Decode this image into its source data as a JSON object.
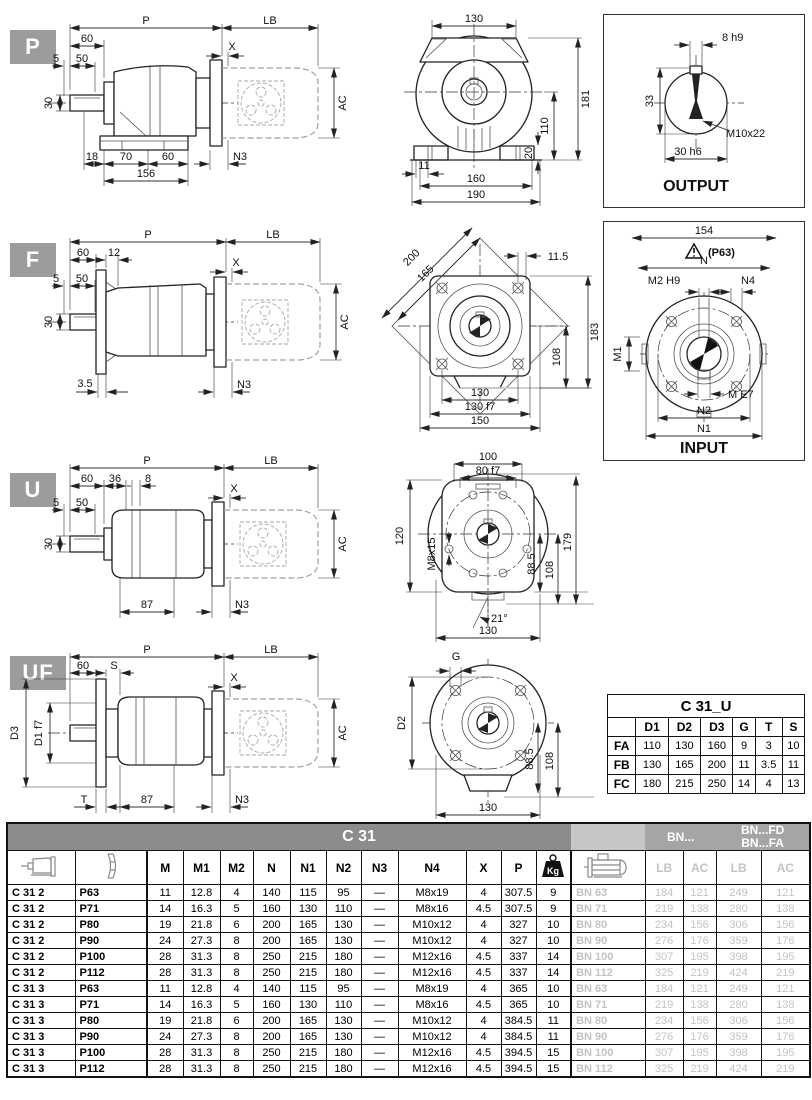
{
  "colors": {
    "header_bar": "#8c8c8c",
    "group_header": "#a5a5a5",
    "muted_text": "#c3c3c3",
    "badge": "#9c9c9c"
  },
  "badges": {
    "p": "P",
    "f": "F",
    "u": "U",
    "uf": "UF"
  },
  "p_side": {
    "P": "P",
    "LB": "LB",
    "n60": "60",
    "X": "X",
    "n5": "5",
    "n50": "50",
    "n30": "30",
    "AC": "AC",
    "n18": "18",
    "n70": "70",
    "n60b": "60",
    "n156": "156",
    "N3": "N3"
  },
  "p_front": {
    "n130": "130",
    "n181": "181",
    "n110": "110",
    "n20": "20",
    "n11": "11",
    "n160": "160",
    "n190": "190"
  },
  "output_box": {
    "k8": "8 h9",
    "n33": "33",
    "m10": "M10x22",
    "k30": "30 h6",
    "title": "OUTPUT"
  },
  "f_side": {
    "P": "P",
    "LB": "LB",
    "n60": "60",
    "n12": "12",
    "X": "X",
    "n5": "5",
    "n50": "50",
    "n30": "30",
    "AC": "AC",
    "n35": "3.5",
    "N3": "N3"
  },
  "f_front": {
    "n200": "200",
    "n165": "165",
    "n115": "11.5",
    "n183": "183",
    "n108": "108",
    "n130": "130",
    "n130f": "130 f7",
    "n150": "150"
  },
  "input_box": {
    "n154": "154",
    "warn": "(P63)",
    "N": "N",
    "M2": "M2 H9",
    "N4": "N4",
    "M1": "M1",
    "ME7": "M E7",
    "N2": "N2",
    "N1": "N1",
    "title": "INPUT"
  },
  "u_side": {
    "P": "P",
    "LB": "LB",
    "n60": "60",
    "n36": "36",
    "n8": "8",
    "X": "X",
    "n5": "5",
    "n50": "50",
    "n30": "30",
    "AC": "AC",
    "n87": "87",
    "N3": "N3"
  },
  "u_front": {
    "n100": "100",
    "n80": "80 f7",
    "n120": "120",
    "m8": "M8x15",
    "n885": "88.5",
    "n108": "108",
    "n179": "179",
    "n21": "21°",
    "n130": "130"
  },
  "uf_side": {
    "P": "P",
    "LB": "LB",
    "n60": "60",
    "S": "S",
    "X": "X",
    "D3": "D3",
    "D1": "D1 f7",
    "AC": "AC",
    "T": "T",
    "n87": "87",
    "N3": "N3"
  },
  "uf_front": {
    "G": "G",
    "D2": "D2",
    "n885": "88.5",
    "n108": "108",
    "n130": "130"
  },
  "c31u": {
    "title": "C 31_U",
    "columns": [
      "D1",
      "D2",
      "D3",
      "G",
      "T",
      "S"
    ],
    "rows": [
      [
        "FA",
        "110",
        "130",
        "160",
        "9",
        "3",
        "10"
      ],
      [
        "FB",
        "130",
        "165",
        "200",
        "11",
        "3.5",
        "11"
      ],
      [
        "FC",
        "180",
        "215",
        "250",
        "14",
        "4",
        "13"
      ]
    ]
  },
  "main": {
    "title": "C 31",
    "bn": "BN...",
    "bnfd": "BN...FD",
    "bnfa": "BN...FA",
    "kg": "Kg",
    "columns": [
      "M",
      "M1",
      "M2",
      "N",
      "N1",
      "N2",
      "N3",
      "N4",
      "X",
      "P"
    ],
    "sub": [
      "LB",
      "AC",
      "LB",
      "AC"
    ],
    "rows": [
      [
        "C 31 2",
        "P63",
        "11",
        "12.8",
        "4",
        "140",
        "115",
        "95",
        "—",
        "M8x19",
        "4",
        "307.5",
        "9",
        "BN 63",
        "184",
        "121",
        "249",
        "121"
      ],
      [
        "C 31 2",
        "P71",
        "14",
        "16.3",
        "5",
        "160",
        "130",
        "110",
        "—",
        "M8x16",
        "4.5",
        "307.5",
        "9",
        "BN 71",
        "219",
        "138",
        "280",
        "138"
      ],
      [
        "C 31 2",
        "P80",
        "19",
        "21.8",
        "6",
        "200",
        "165",
        "130",
        "—",
        "M10x12",
        "4",
        "327",
        "10",
        "BN 80",
        "234",
        "156",
        "306",
        "156"
      ],
      [
        "C 31 2",
        "P90",
        "24",
        "27.3",
        "8",
        "200",
        "165",
        "130",
        "—",
        "M10x12",
        "4",
        "327",
        "10",
        "BN 90",
        "276",
        "176",
        "359",
        "176"
      ],
      [
        "C 31 2",
        "P100",
        "28",
        "31.3",
        "8",
        "250",
        "215",
        "180",
        "—",
        "M12x16",
        "4.5",
        "337",
        "14",
        "BN 100",
        "307",
        "195",
        "398",
        "195"
      ],
      [
        "C 31 2",
        "P112",
        "28",
        "31.3",
        "8",
        "250",
        "215",
        "180",
        "—",
        "M12x16",
        "4.5",
        "337",
        "14",
        "BN 112",
        "325",
        "219",
        "424",
        "219"
      ],
      [
        "C 31 3",
        "P63",
        "11",
        "12.8",
        "4",
        "140",
        "115",
        "95",
        "—",
        "M8x19",
        "4",
        "365",
        "10",
        "BN 63",
        "184",
        "121",
        "249",
        "121"
      ],
      [
        "C 31 3",
        "P71",
        "14",
        "16.3",
        "5",
        "160",
        "130",
        "110",
        "—",
        "M8x16",
        "4.5",
        "365",
        "10",
        "BN 71",
        "219",
        "138",
        "280",
        "138"
      ],
      [
        "C 31 3",
        "P80",
        "19",
        "21.8",
        "6",
        "200",
        "165",
        "130",
        "—",
        "M10x12",
        "4",
        "384.5",
        "11",
        "BN 80",
        "234",
        "156",
        "306",
        "156"
      ],
      [
        "C 31 3",
        "P90",
        "24",
        "27.3",
        "8",
        "200",
        "165",
        "130",
        "—",
        "M10x12",
        "4",
        "384.5",
        "11",
        "BN 90",
        "276",
        "176",
        "359",
        "176"
      ],
      [
        "C 31 3",
        "P100",
        "28",
        "31.3",
        "8",
        "250",
        "215",
        "180",
        "—",
        "M12x16",
        "4.5",
        "394.5",
        "15",
        "BN 100",
        "307",
        "195",
        "398",
        "195"
      ],
      [
        "C 31 3",
        "P112",
        "28",
        "31.3",
        "8",
        "250",
        "215",
        "180",
        "—",
        "M12x16",
        "4.5",
        "394.5",
        "15",
        "BN 112",
        "325",
        "219",
        "424",
        "219"
      ]
    ]
  }
}
